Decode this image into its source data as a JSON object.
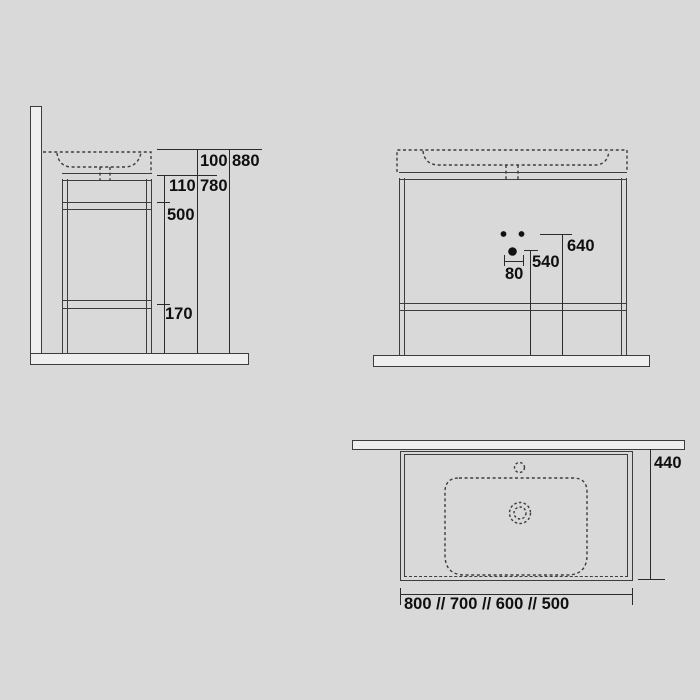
{
  "drawing": {
    "colors": {
      "background": "#d9d9d9",
      "structure_line": "#3d3d3d",
      "dimension_line": "#2b2b2b",
      "text": "#0f0f0f",
      "panel_fill": "#efefef"
    },
    "views": {
      "side": {
        "basin_height": "100",
        "overall_height": "880",
        "apron_height": "110",
        "frame_height": "780",
        "mid_section": "500",
        "foot_height": "170"
      },
      "front": {
        "hole_spacing": "80",
        "drain_height": "540",
        "inlet_height": "640"
      },
      "top": {
        "depth": "440",
        "width_options": "800 // 700 // 600 // 500"
      }
    }
  }
}
